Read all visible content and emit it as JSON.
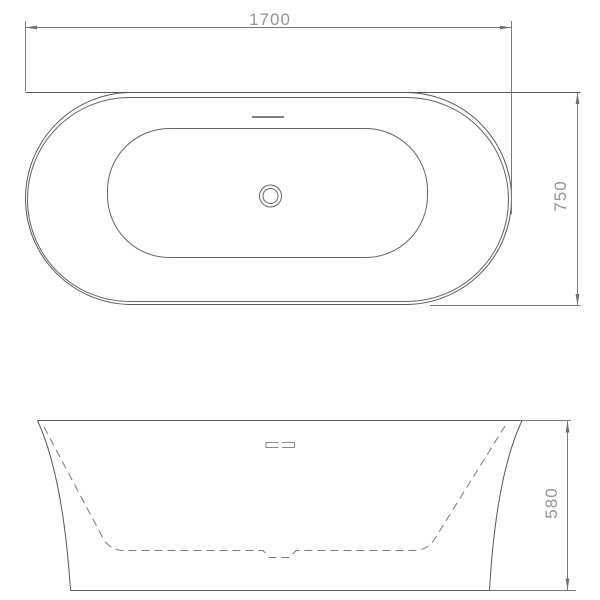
{
  "diagram": {
    "subject": "Bathtub technical dimension drawing with two orthographic views",
    "background_color": "#ffffff",
    "object_line_color": "#585858",
    "dim_line_color": "#7a7a7a",
    "dim_text_color": "#969696",
    "top_view": {
      "name": "plan view",
      "length_dim": "1700",
      "width_dim": "750",
      "features": [
        "outer rim",
        "inner rim edge",
        "basin outline",
        "center drain",
        "overflow slot"
      ]
    },
    "front_view": {
      "name": "front elevation",
      "height_dim": "580",
      "features": [
        "flared body profile",
        "hidden basin outline dashed",
        "overflow slots",
        "drain recess"
      ]
    }
  }
}
